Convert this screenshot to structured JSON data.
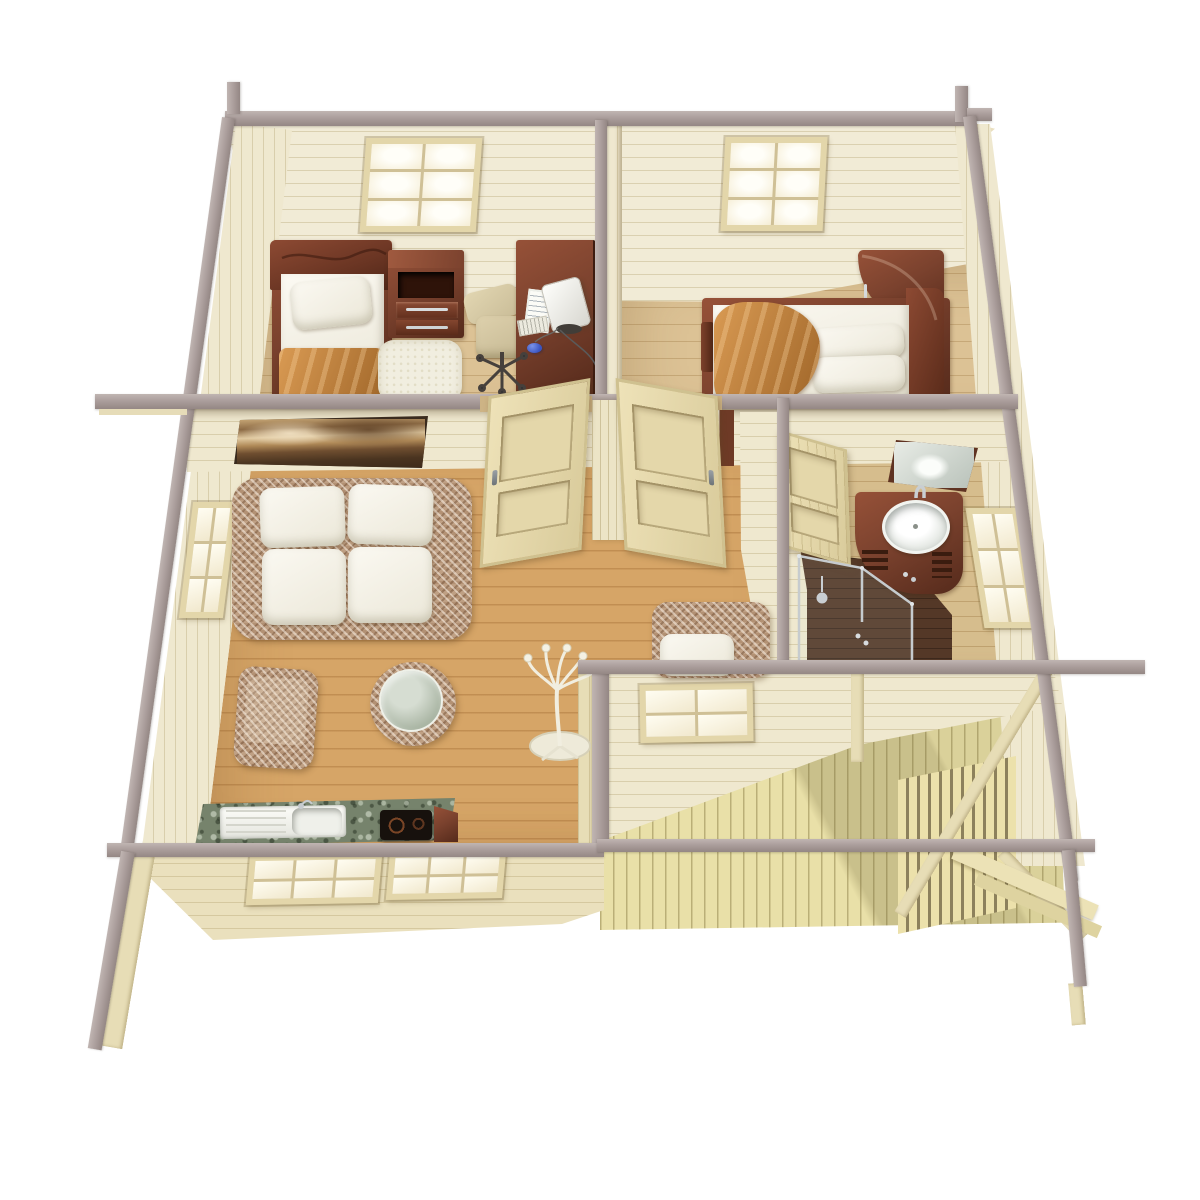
{
  "scene": {
    "title": "Overhead 3D cutaway floor plan render of a one-storey wooden cabin with porch",
    "view": "bird's-eye dollhouse cutaway, walls sliced flat with grey top plates",
    "background": "#ffffff"
  },
  "palette": {
    "beam": "#ab9e9c",
    "beam-light": "#c0b5b2",
    "beam-dark": "#948784",
    "wall": "#efe8cf",
    "wall-ext": "#eae0bd",
    "floor-bed": "#dcc295",
    "floor-living": "#d6a567",
    "floor-bath": "#d6bd8d",
    "floor-porch": "#e9e0a8",
    "shower": "#543827",
    "wood": "#7b422e",
    "wood-light": "#965138",
    "wood-dark": "#552a1b",
    "fabric": "#f4f1e8",
    "wicker": "#bfa084",
    "blanket": "#c5823a",
    "granite": "#76836c",
    "cooktop": "#17110d",
    "chrome": "#c6cbce",
    "mirror": "#ccd3cb",
    "frame": "#e3d6aa",
    "mullion": "#cfc096",
    "glass": "#fdf8e8"
  },
  "windows": {
    "skylight_left": {
      "cols": 2,
      "rows": 3
    },
    "skylight_right": {
      "cols": 2,
      "rows": 3
    },
    "living_left": {
      "cols": 2,
      "rows": 3
    },
    "bath_right": {
      "cols": 2,
      "rows": 3
    },
    "porch": {
      "cols": 2,
      "rows": 2
    },
    "kitchen_a": {
      "cols": 3,
      "rows": 2
    },
    "kitchen_b": {
      "cols": 3,
      "rows": 2
    }
  },
  "rooms": [
    {
      "id": "bedroom-left",
      "name": "Bedroom 1",
      "furniture": [
        "single bed with white pillow and orange blanket",
        "dark wood headboard with wave groove",
        "nightstand with open shelf and two drawers",
        "computer desk with white monitor, keyboard, paper and blue mouse",
        "beige office chair",
        "white shag rug"
      ],
      "windows": [
        "roof skylight 2x3 panes"
      ]
    },
    {
      "id": "bedroom-right",
      "name": "Bedroom 2",
      "furniture": [
        "double bed with two white pillows and orange throw",
        "dark wood corner cabinet with curved front"
      ],
      "windows": [
        "roof skylight 2x3 panes"
      ]
    },
    {
      "id": "living-room",
      "name": "Living room with kitchenette",
      "furniture": [
        "framed sepia landscape painting",
        "wicker loveseat with four white cushions",
        "wicker ottoman",
        "round wicker table with glass top",
        "white coat stand",
        "wicker armchair with white cushion",
        "green granite kitchen counter with sink, drainboard and black cooktop"
      ],
      "windows": [
        "left wall window 2x3",
        "porch-facing window 2x2",
        "two front-wall windows 3x2"
      ]
    },
    {
      "id": "bathroom",
      "name": "Bathroom",
      "furniture": [
        "corner vanity in dark wood with round white basin and chrome faucet",
        "tilted wood-framed mirror",
        "corner shower with chrome-framed glass and dark floor"
      ],
      "windows": [
        "right wall window 2x3"
      ]
    },
    {
      "id": "porch",
      "name": "Covered porch / deck",
      "furniture": [
        "plank decking",
        "slatted railing",
        "diagonal corner braces",
        "grey roof beams"
      ]
    }
  ],
  "doors": [
    {
      "id": "door-bedroom-left",
      "state": "open into living room"
    },
    {
      "id": "door-bedroom-right",
      "state": "open into living room"
    },
    {
      "id": "door-bathroom",
      "state": "open into bathroom"
    }
  ]
}
